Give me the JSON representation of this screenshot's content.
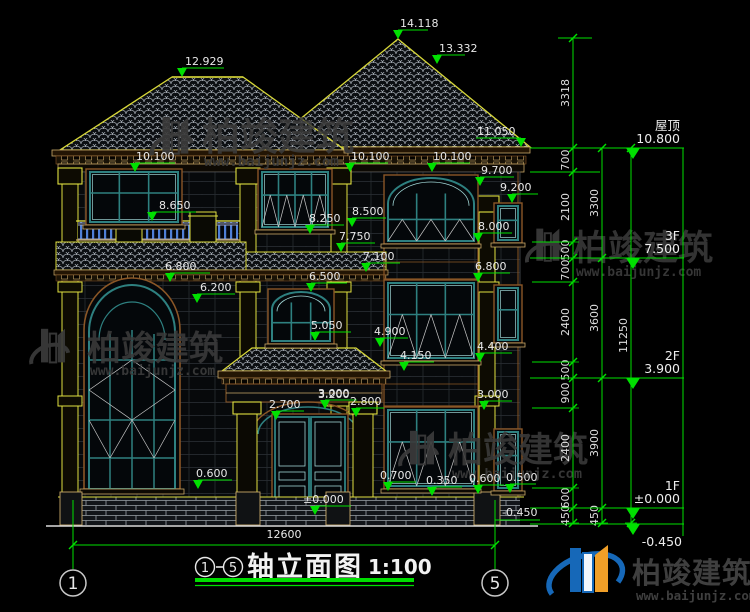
{
  "brand": {
    "name": "柏竣建筑",
    "site": "www.baijunjz.com"
  },
  "title": {
    "axis_from": "1",
    "axis_to": "5",
    "separator": "-",
    "text": "轴立面图",
    "scale": "1:100"
  },
  "bottom_dim": {
    "value": "12600",
    "x1": 73,
    "x2": 495,
    "y": 545
  },
  "axes": [
    {
      "label": "1",
      "x": 73
    },
    {
      "label": "5",
      "x": 495
    }
  ],
  "colors": {
    "dim_green": "#00e000",
    "text": "#e8e8e8",
    "roof_edge": "#d8d838",
    "frame_teal": "#2e8080",
    "trim_brown": "#8a5626",
    "balustrade_blue": "#4f7fd8",
    "watermark": "#3b3b3b",
    "logo_blue": "#1668b8",
    "logo_orange": "#f09f28"
  },
  "levels": [
    {
      "name": "屋顶",
      "value": "10.800",
      "y": 148
    },
    {
      "name": "3F",
      "value": "7.500",
      "y": 258
    },
    {
      "name": "2F",
      "value": "3.900",
      "y": 378
    },
    {
      "name": "1F",
      "value": "±0.000",
      "y": 508
    },
    {
      "name": "",
      "value": "-0.450",
      "y": 524,
      "below": true
    }
  ],
  "elevation_markers": [
    {
      "v": "12.929",
      "x": 182,
      "y": 77,
      "dx": 42,
      "tx": 185
    },
    {
      "v": "14.118",
      "x": 398,
      "y": 39,
      "dx": 30,
      "tx": 400
    },
    {
      "v": "13.332",
      "x": 437,
      "y": 64,
      "dx": 28,
      "tx": 439
    },
    {
      "v": "11.050",
      "x": 521,
      "y": 147,
      "dx": -45,
      "tx": 477
    },
    {
      "v": "10.100",
      "x": 135,
      "y": 172,
      "dx": 40,
      "tx": 136
    },
    {
      "v": "10.100",
      "x": 350,
      "y": 172,
      "dx": 38,
      "tx": 351
    },
    {
      "v": "10.100",
      "x": 432,
      "y": 172,
      "dx": 38,
      "tx": 433
    },
    {
      "v": "9.700",
      "x": 480,
      "y": 186,
      "dx": 34,
      "tx": 481
    },
    {
      "v": "9.200",
      "x": 512,
      "y": 203,
      "dx": 26,
      "tx": 500
    },
    {
      "v": "8.650",
      "x": 152,
      "y": 221,
      "dx": 44,
      "tx": 159
    },
    {
      "v": "8.500",
      "x": 352,
      "y": 227,
      "dx": 34,
      "tx": 352
    },
    {
      "v": "8.250",
      "x": 310,
      "y": 234,
      "dx": 34,
      "tx": 309
    },
    {
      "v": "8.000",
      "x": 478,
      "y": 242,
      "dx": 34,
      "tx": 478
    },
    {
      "v": "7.750",
      "x": 341,
      "y": 252,
      "dx": 34,
      "tx": 339
    },
    {
      "v": "7.100",
      "x": 366,
      "y": 272,
      "dx": 34,
      "tx": 363
    },
    {
      "v": "6.800",
      "x": 170,
      "y": 282,
      "dx": 40,
      "tx": 165
    },
    {
      "v": "6.500",
      "x": 311,
      "y": 292,
      "dx": 36,
      "tx": 309
    },
    {
      "v": "6.800",
      "x": 478,
      "y": 282,
      "dx": 32,
      "tx": 475
    },
    {
      "v": "6.200",
      "x": 197,
      "y": 303,
      "dx": 38,
      "tx": 200
    },
    {
      "v": "5.050",
      "x": 315,
      "y": 341,
      "dx": 36,
      "tx": 311
    },
    {
      "v": "4.900",
      "x": 380,
      "y": 347,
      "dx": 28,
      "tx": 374
    },
    {
      "v": "4.400",
      "x": 480,
      "y": 362,
      "dx": 32,
      "tx": 477
    },
    {
      "v": "4.150",
      "x": 404,
      "y": 371,
      "dx": 30,
      "tx": 400
    },
    {
      "v": "3.000",
      "x": 325,
      "y": 409,
      "dx": 32,
      "tx": 318
    },
    {
      "v": "2.700",
      "x": 276,
      "y": 420,
      "dx": 28,
      "tx": 269
    },
    {
      "v": "2.800",
      "x": 356,
      "y": 417,
      "dx": 28,
      "tx": 350
    },
    {
      "v": "3.000",
      "x": 484,
      "y": 410,
      "dx": 28,
      "tx": 477
    },
    {
      "v": "±0.000",
      "x": 315,
      "y": 515,
      "dx": 36,
      "tx": 303
    },
    {
      "v": "0.600",
      "x": 198,
      "y": 489,
      "dx": 34,
      "tx": 196
    },
    {
      "v": "0.700",
      "x": 388,
      "y": 491,
      "dx": 28,
      "tx": 380
    },
    {
      "v": "0.350",
      "x": 432,
      "y": 496,
      "dx": 30,
      "tx": 426
    },
    {
      "v": "0.600",
      "x": 478,
      "y": 494,
      "dx": 26,
      "tx": 469
    },
    {
      "v": "0.500",
      "x": 510,
      "y": 493,
      "dx": 26,
      "tx": 506
    }
  ],
  "free_texts": [
    {
      "t": "3.200",
      "x": 318,
      "y": 398
    },
    {
      "t": "-0.450",
      "x": 502,
      "y": 516
    }
  ],
  "dim_chains": [
    {
      "x": 573,
      "segs": [
        {
          "v": "3318",
          "y1": 38,
          "y2": 148
        },
        {
          "v": "700",
          "y1": 148,
          "y2": 172
        },
        {
          "v": "2100",
          "y1": 172,
          "y2": 242
        },
        {
          "v": "500",
          "y1": 242,
          "y2": 258
        },
        {
          "v": "700",
          "y1": 258,
          "y2": 282
        },
        {
          "v": "2400",
          "y1": 282,
          "y2": 362
        },
        {
          "v": "500",
          "y1": 362,
          "y2": 378
        },
        {
          "v": "900",
          "y1": 378,
          "y2": 408
        },
        {
          "v": "2400",
          "y1": 408,
          "y2": 488
        },
        {
          "v": "600",
          "y1": 488,
          "y2": 508
        },
        {
          "v": "450",
          "y1": 508,
          "y2": 523
        }
      ]
    },
    {
      "x": 602,
      "segs": [
        {
          "v": "3300",
          "y1": 148,
          "y2": 258
        },
        {
          "v": "3600",
          "y1": 258,
          "y2": 378
        },
        {
          "v": "3900",
          "y1": 378,
          "y2": 508
        },
        {
          "v": "450",
          "y1": 508,
          "y2": 523
        }
      ]
    },
    {
      "x": 631,
      "segs": [
        {
          "v": "11250",
          "y1": 148,
          "y2": 523
        }
      ]
    }
  ]
}
